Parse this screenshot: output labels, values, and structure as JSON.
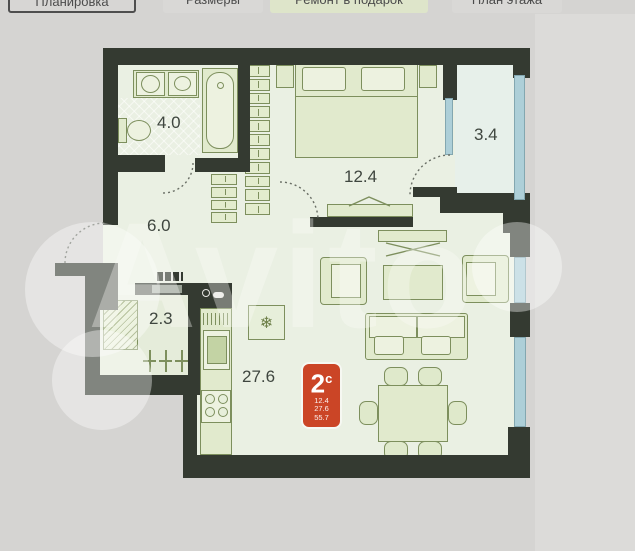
{
  "tabs": [
    {
      "label": "Планировка",
      "state": "selected"
    },
    {
      "label": "Размеры",
      "state": "normal"
    },
    {
      "label": "Ремонт в подарок",
      "state": "highlighted"
    },
    {
      "label": "План этажа",
      "state": "normal"
    }
  ],
  "watermark": {
    "text": "Avito"
  },
  "plan": {
    "labels": {
      "bathroom": "4.0",
      "hallway": "6.0",
      "wardrobe": "2.3",
      "kitchen_living": "27.6",
      "bedroom": "12.4",
      "balcony": "3.4"
    },
    "badge": {
      "type_number": "2",
      "type_letter": "с",
      "line1": "12.4",
      "line2": "27.6",
      "line3": "55.7",
      "color": "#cb4526"
    },
    "icons": {
      "fridge": "❄"
    },
    "colors": {
      "wall": "#343a31",
      "room_fill": "#eaf0e3",
      "furniture_fill": "#e1eacd",
      "furniture_stroke": "#7d8f5d",
      "glazing": "#adcfd8",
      "badge": "#cb4526"
    }
  }
}
